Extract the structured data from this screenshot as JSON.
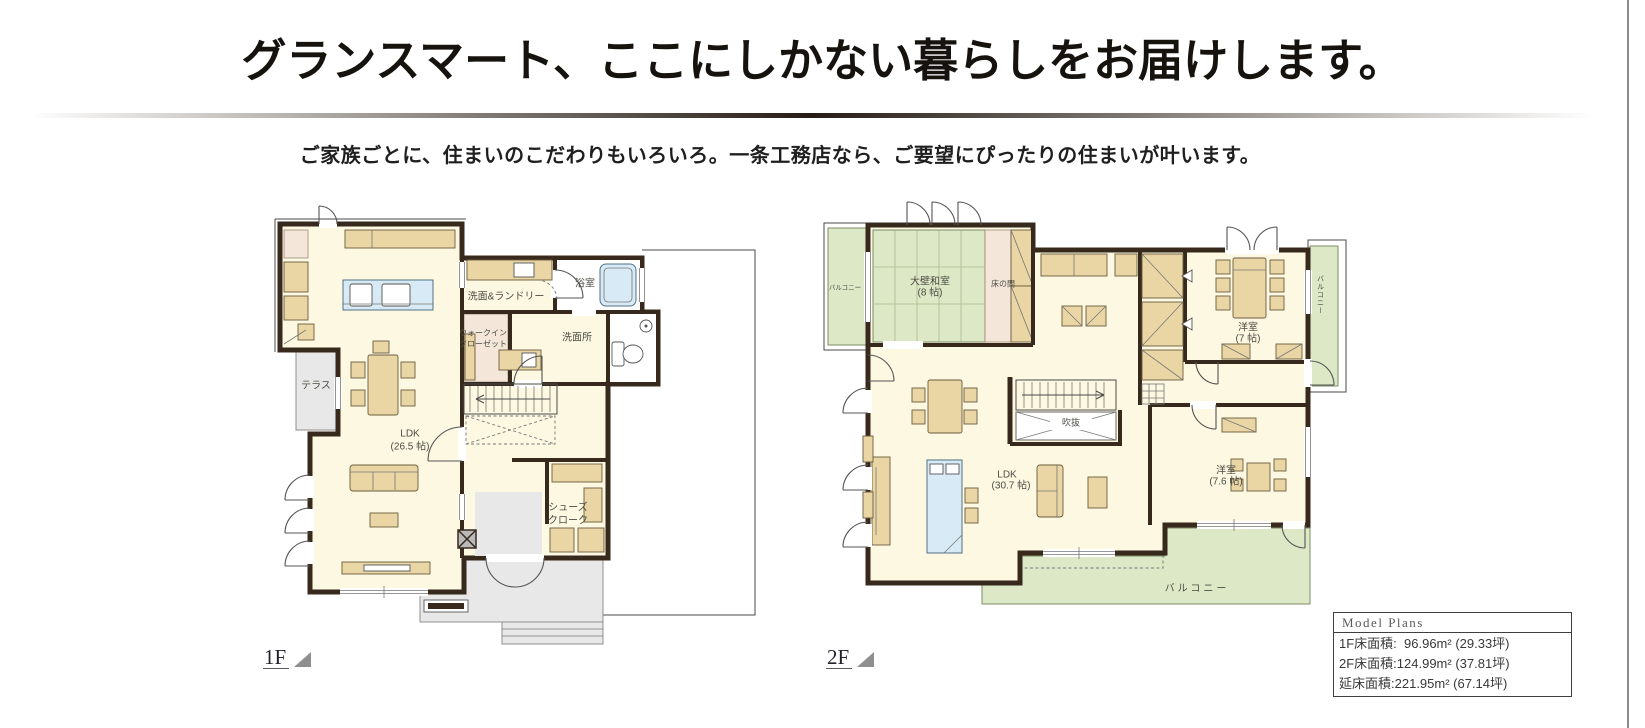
{
  "header": {
    "title": "グランスマート、ここにしかない暮らしをお届けします。",
    "subtitle": "ご家族ごとに、住まいのこだわりもいろいろ。一条工務店なら、ご要望にぴったりの住まいが叶います。"
  },
  "floor1": {
    "tag": "1F",
    "rooms": {
      "bathroom": "浴室",
      "laundry": "洗面&ランドリー",
      "wic_line1": "ウォークイン",
      "wic_line2": "クローゼット",
      "washroom": "洗面所",
      "terrace": "テラス",
      "ldk_line1": "LDK",
      "ldk_line2": "(26.5 帖)",
      "shoes_line1": "シューズ",
      "shoes_line2": "クローク"
    }
  },
  "floor2": {
    "tag": "2F",
    "rooms": {
      "balcony_left": "バルコニー",
      "washitsu_line1": "大壁和室",
      "washitsu_line2": "(8 帖)",
      "tokonoma": "床の間",
      "western1_line1": "洋室",
      "western1_line2": "(7 帖)",
      "balcony_right": "バルコニー",
      "void": "吹抜",
      "ldk_line1": "LDK",
      "ldk_line2": "(30.7 帖)",
      "western2_line1": "洋室",
      "western2_line2": "(7.6 帖)",
      "balcony_bottom": "バルコニー"
    }
  },
  "model_plans": {
    "title": "Model Plans",
    "rows": [
      {
        "label": "1F床面積:",
        "value": "  96.96m² (29.33坪)"
      },
      {
        "label": "2F床面積:",
        "value": "124.99m² (37.81坪)"
      },
      {
        "label": "延床面積:",
        "value": "221.95m² (67.14坪)"
      }
    ]
  },
  "colors": {
    "wall": "#38291d",
    "floor": "#fdf8e1",
    "tatami": "#dce8c6",
    "furniture": "#e9d6a4",
    "water": "#d8eaf5",
    "terrace": "#e8e8e8"
  }
}
